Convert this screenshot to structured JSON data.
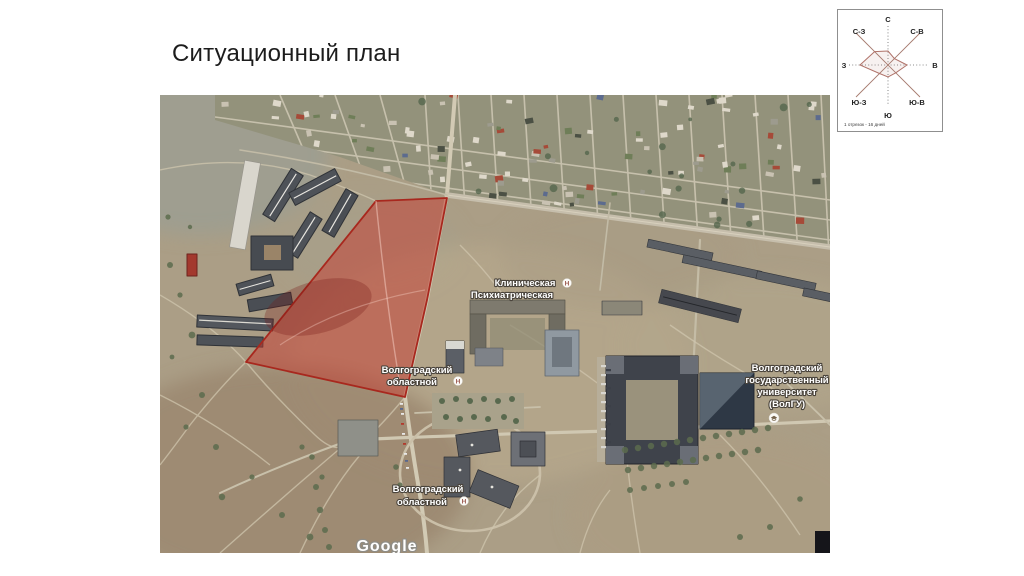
{
  "slide": {
    "title": "Ситуационный план"
  },
  "map": {
    "attribution": "Google",
    "site": {
      "fill": "rgba(198,55,45,0.5)",
      "outline": "#a8281e"
    },
    "labels": [
      {
        "lines": [
          "Клиническая",
          "Психиатрическая"
        ],
        "marker": "hospital"
      },
      {
        "lines": [
          "Волгоградский",
          "областной"
        ],
        "marker": "hospital"
      },
      {
        "lines": [
          "Волгоградский",
          "государственный",
          "университет",
          "(ВолГУ)"
        ],
        "marker": "university"
      },
      {
        "lines": [
          "Волгоградский",
          "областной"
        ],
        "marker": "hospital"
      }
    ]
  },
  "wind_rose": {
    "directions": [
      "С",
      "С-В",
      "В",
      "Ю-В",
      "Ю",
      "Ю-З",
      "З",
      "С-З"
    ],
    "values": [
      14,
      9,
      19,
      11,
      12,
      12,
      28,
      19
    ],
    "caption": "1 отрезок - 16 дней"
  }
}
